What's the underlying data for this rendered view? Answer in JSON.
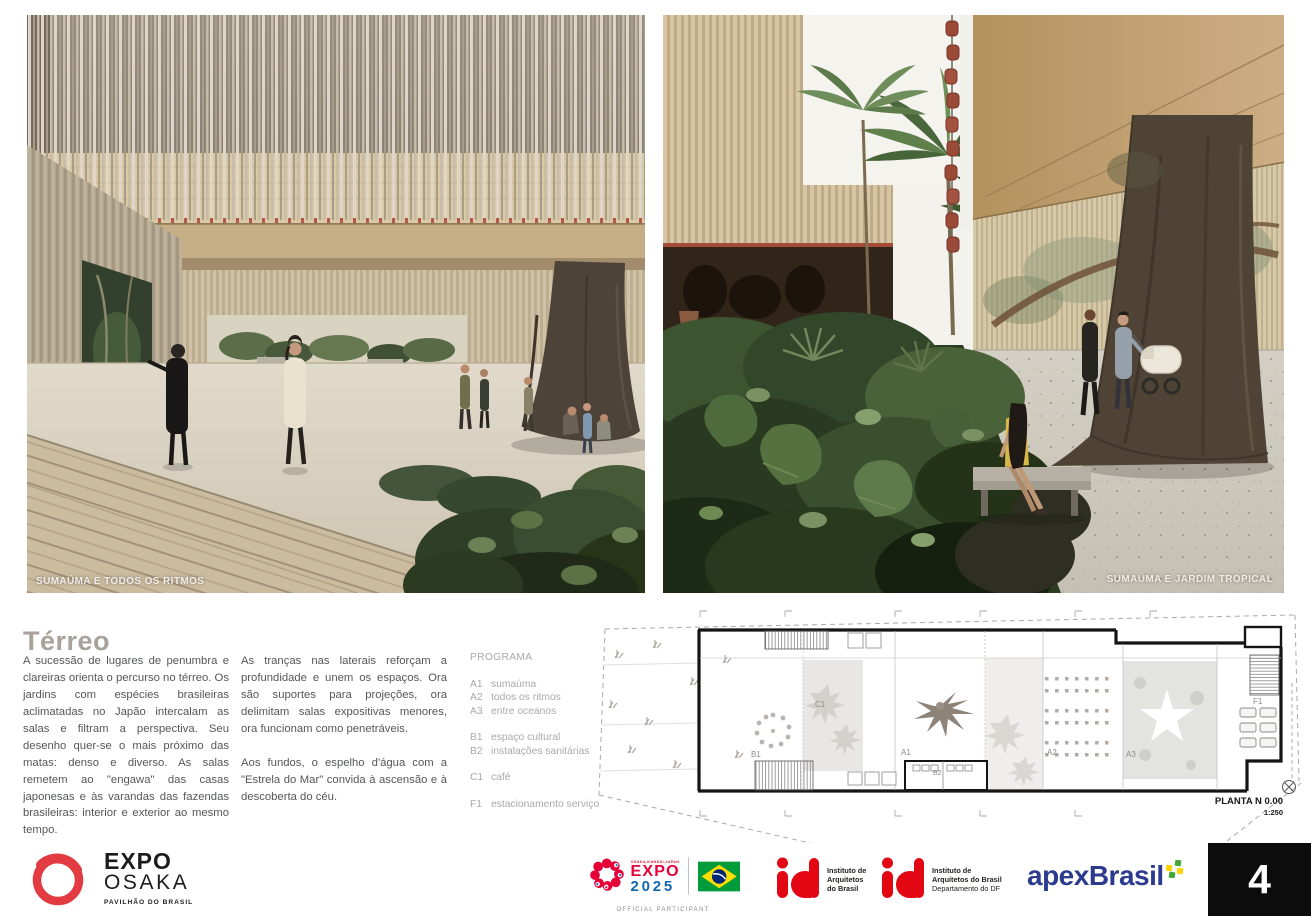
{
  "renders": [
    {
      "caption": "SUMAÚMA E TODOS OS RITMOS"
    },
    {
      "caption": "SUMAÚMA E JARDIM TROPICAL"
    }
  ],
  "section": {
    "title": "Térreo",
    "col1_paragraphs": [
      "A sucessão de lugares de penumbra e clareiras orienta o percurso no térreo. Os jardins com espécies brasileiras aclimatadas no Japão intercalam as salas e filtram a perspectiva. Seu desenho quer-se o mais próximo das matas: denso e diverso. As salas remetem ao \"engawa\" das casas japonesas e às varandas das fazendas brasileiras: interior e exterior ao mesmo tempo."
    ],
    "col2_paragraphs": [
      "As tranças nas laterais reforçam a profundidade e unem os espaços. Ora são suportes para projeções, ora delimitam salas expositivas menores, ora funcionam como penetráveis.",
      "Aos fundos, o espelho d'água com a \"Estrela do Mar\" convida à ascensão e à descoberta do céu."
    ]
  },
  "program": {
    "title": "PROGRAMA",
    "items": [
      {
        "code": "A1",
        "label": "sumaúma"
      },
      {
        "code": "A2",
        "label": "todos os ritmos"
      },
      {
        "code": "A3",
        "label": "entre oceanos"
      },
      {
        "code": "B1",
        "label": "espaço cultural"
      },
      {
        "code": "B2",
        "label": "instalações sanitárias"
      },
      {
        "code": "C1",
        "label": "café"
      },
      {
        "code": "F1",
        "label": "estacionamento serviço"
      }
    ]
  },
  "plan": {
    "title": "PLANTA N 0.00",
    "scale": "1:250",
    "room_labels": {
      "A1": "A1",
      "A2": "A2",
      "A3": "A3",
      "B1": "B1",
      "B2": "B2",
      "C1": "C1",
      "F1": "F1"
    }
  },
  "footer": {
    "expo_osaka": {
      "line1": "EXPO",
      "line2": "OSAKA",
      "subtitle": "PAVILHÃO DO BRASIL"
    },
    "expo2025": {
      "top": "OSAKA,KANSAI,JAPAN",
      "line1": "EXPO",
      "line2": "2025",
      "participant": "OFFICIAL PARTICIPANT"
    },
    "iab_national": {
      "line1": "Instituto de",
      "line2": "Arquitetos",
      "line3": "do Brasil"
    },
    "iab_df": {
      "line1": "Instituto de",
      "line2": "Arquitetos do Brasil",
      "line3": "Departamento do DF"
    },
    "apex": {
      "label": "apexBrasil"
    },
    "page_number": "4"
  },
  "colors": {
    "title_grey": "#a8a29a",
    "body_text": "#55565a",
    "legend_grey": "#a9a9a9",
    "expo_osaka_red": "#e23b41",
    "expo2025_red": "#e50038",
    "expo2025_blue": "#1268b3",
    "flag_green": "#009b3a",
    "flag_yellow": "#fedd00",
    "flag_blue": "#002776",
    "iab_red": "#e30613",
    "apex_blue": "#2c3b8d",
    "apex_green": "#43a536",
    "apex_yellow": "#ffd400",
    "page_box_black": "#0c0c0c"
  }
}
